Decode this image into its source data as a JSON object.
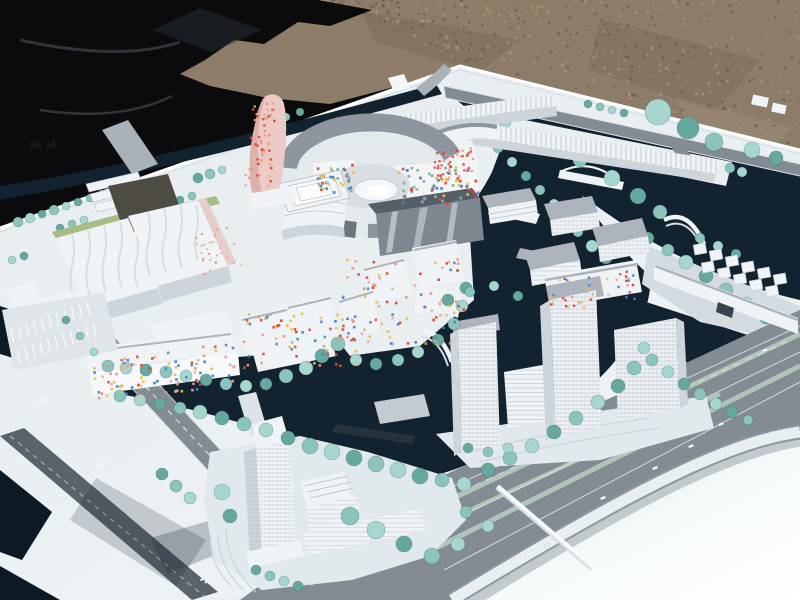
{
  "meta": {
    "subject": "photograph of a white architectural urban-planning scale model",
    "environment": "model lying outdoors on gravel ground, partly bordered by a black tarp",
    "features": [
      "white buildings",
      "dark navy canals",
      "seafoam model trees",
      "gray roads",
      "pink dotted tower",
      "circular courtyard complex with colorful mosaic facades",
      "arched white bridges",
      "curved highway ramp",
      "empty white plaza"
    ]
  },
  "palette": {
    "gravel": "#8d7c68",
    "gravel_dark": "#6b5d4c",
    "gravel_light": "#a6957e",
    "tarp": "#0b0b0d",
    "tarp_fold": "#32323a",
    "base": "#e9eef1",
    "base_bright": "#f6fafb",
    "base_shade": "#d4dce1",
    "water": "#12222f",
    "water_deep": "#0c1a26",
    "shallow": "#3e7a74",
    "tree_1": "#8ac4bb",
    "tree_2": "#a6d6cd",
    "tree_3": "#66a89e",
    "road": "#838b93",
    "road_dark": "#5a626c",
    "road_light": "#aab2b9",
    "median_green": "#b3c5b8",
    "curb": "#dde3e7",
    "bldg_white": "#f0f3f5",
    "bldg_face": "#cdd4da",
    "bldg_shade": "#b4bcc4",
    "roof_gray": "#8e959f",
    "roof_dark": "#6d747e",
    "roof_light": "#aeb4bc",
    "glass_dark": "#7e8690",
    "glass_ridge": "#565e68",
    "pink_tower": "#eccac5",
    "pink_shade": "#d9aba6",
    "green_strip": "#a9bc85",
    "dark_block": "#4e4a44",
    "red_face": "#b56c60",
    "dot_red": "#d94836",
    "dot_blue": "#4a82cc",
    "dot_yellow": "#e5c14e",
    "dot_salmon": "#e8937f",
    "dot_teal": "#7fb3a8",
    "dot_pink": "#e8a8a0",
    "shadow": "#1d2832"
  },
  "scene": {
    "speckle": {
      "count": 520,
      "seed": 7
    },
    "tree_colors": [
      "tree_1",
      "tree_2",
      "tree_3"
    ],
    "trees_back": [
      [
        18,
        222,
        5
      ],
      [
        30,
        218,
        5
      ],
      [
        42,
        214,
        4
      ],
      [
        54,
        210,
        5
      ],
      [
        66,
        206,
        4
      ],
      [
        78,
        202,
        4
      ],
      [
        90,
        198,
        4
      ],
      [
        102,
        194,
        4
      ],
      [
        198,
        178,
        5
      ],
      [
        210,
        174,
        5
      ],
      [
        222,
        170,
        4
      ],
      [
        310,
        142,
        4
      ],
      [
        322,
        138,
        4
      ],
      [
        334,
        134,
        4
      ],
      [
        300,
        112,
        4
      ],
      [
        286,
        117,
        4
      ],
      [
        658,
        112,
        13
      ],
      [
        688,
        128,
        11
      ],
      [
        714,
        142,
        9
      ],
      [
        752,
        150,
        8
      ],
      [
        776,
        158,
        7
      ],
      [
        480,
        112,
        7
      ],
      [
        505,
        122,
        6
      ],
      [
        548,
        143,
        7
      ],
      [
        580,
        160,
        7
      ],
      [
        612,
        178,
        8
      ],
      [
        638,
        196,
        8
      ],
      [
        660,
        212,
        7
      ],
      [
        475,
        128,
        4
      ],
      [
        488,
        131,
        4
      ],
      [
        501,
        134,
        4
      ],
      [
        514,
        137,
        4
      ],
      [
        588,
        104,
        4
      ],
      [
        600,
        107,
        4
      ],
      [
        612,
        110,
        4
      ],
      [
        624,
        113,
        4
      ],
      [
        730,
        168,
        5
      ],
      [
        742,
        172,
        5
      ],
      [
        648,
        238,
        6
      ],
      [
        668,
        250,
        6
      ],
      [
        686,
        262,
        7
      ],
      [
        706,
        276,
        7
      ],
      [
        726,
        290,
        7
      ],
      [
        746,
        304,
        7
      ],
      [
        766,
        318,
        6
      ],
      [
        700,
        238,
        5
      ],
      [
        718,
        246,
        5
      ],
      [
        736,
        254,
        5
      ],
      [
        498,
        148,
        5
      ],
      [
        512,
        162,
        5
      ],
      [
        526,
        176,
        5
      ],
      [
        540,
        190,
        5
      ],
      [
        554,
        204,
        5
      ],
      [
        566,
        218,
        5
      ],
      [
        578,
        232,
        5
      ],
      [
        592,
        246,
        6
      ],
      [
        606,
        258,
        6
      ],
      [
        350,
        128,
        4
      ],
      [
        362,
        124,
        4
      ],
      [
        374,
        121,
        4
      ],
      [
        446,
        120,
        4
      ],
      [
        458,
        117,
        4
      ],
      [
        60,
        228,
        4
      ],
      [
        72,
        224,
        4
      ],
      [
        84,
        220,
        4
      ],
      [
        180,
        200,
        4
      ],
      [
        192,
        196,
        4
      ],
      [
        12,
        260,
        4
      ],
      [
        24,
        256,
        4
      ],
      [
        150,
        232,
        4
      ]
    ],
    "trees_front": [
      [
        108,
        366,
        6
      ],
      [
        126,
        368,
        6
      ],
      [
        146,
        370,
        6
      ],
      [
        166,
        372,
        6
      ],
      [
        186,
        376,
        6
      ],
      [
        206,
        380,
        6
      ],
      [
        226,
        384,
        6
      ],
      [
        246,
        386,
        6
      ],
      [
        266,
        384,
        6
      ],
      [
        286,
        376,
        7
      ],
      [
        306,
        368,
        7
      ],
      [
        322,
        356,
        7
      ],
      [
        338,
        344,
        7
      ],
      [
        356,
        360,
        6
      ],
      [
        376,
        364,
        6
      ],
      [
        398,
        360,
        6
      ],
      [
        418,
        352,
        6
      ],
      [
        438,
        340,
        6
      ],
      [
        454,
        324,
        6
      ],
      [
        462,
        306,
        6
      ],
      [
        466,
        288,
        6
      ],
      [
        120,
        396,
        6
      ],
      [
        140,
        400,
        6
      ],
      [
        160,
        404,
        6
      ],
      [
        180,
        408,
        6
      ],
      [
        200,
        412,
        7
      ],
      [
        222,
        418,
        7
      ],
      [
        244,
        424,
        7
      ],
      [
        266,
        430,
        7
      ],
      [
        288,
        438,
        7
      ],
      [
        310,
        446,
        8
      ],
      [
        332,
        452,
        8
      ],
      [
        354,
        458,
        8
      ],
      [
        376,
        464,
        8
      ],
      [
        398,
        470,
        8
      ],
      [
        420,
        476,
        8
      ],
      [
        442,
        480,
        7
      ],
      [
        464,
        484,
        7
      ],
      [
        488,
        470,
        7
      ],
      [
        510,
        458,
        7
      ],
      [
        532,
        446,
        7
      ],
      [
        554,
        432,
        7
      ],
      [
        576,
        418,
        7
      ],
      [
        598,
        402,
        7
      ],
      [
        618,
        386,
        7
      ],
      [
        634,
        368,
        7
      ],
      [
        644,
        348,
        6
      ],
      [
        448,
        300,
        6
      ],
      [
        470,
        292,
        5
      ],
      [
        494,
        286,
        5
      ],
      [
        518,
        296,
        5
      ],
      [
        652,
        360,
        6
      ],
      [
        668,
        372,
        6
      ],
      [
        684,
        384,
        6
      ],
      [
        700,
        394,
        6
      ],
      [
        716,
        404,
        6
      ],
      [
        732,
        412,
        6
      ],
      [
        748,
        420,
        5
      ],
      [
        222,
        492,
        8
      ],
      [
        230,
        516,
        7
      ],
      [
        350,
        516,
        9
      ],
      [
        376,
        530,
        9
      ],
      [
        404,
        544,
        8
      ],
      [
        432,
        556,
        8
      ],
      [
        458,
        544,
        7
      ],
      [
        256,
        570,
        5
      ],
      [
        270,
        576,
        5
      ],
      [
        284,
        581,
        5
      ],
      [
        298,
        586,
        5
      ],
      [
        466,
        512,
        6
      ],
      [
        488,
        526,
        6
      ],
      [
        66,
        320,
        4
      ],
      [
        80,
        336,
        4
      ],
      [
        94,
        352,
        4
      ],
      [
        162,
        474,
        6
      ],
      [
        176,
        486,
        6
      ],
      [
        190,
        498,
        6
      ],
      [
        468,
        448,
        5
      ],
      [
        488,
        452,
        5
      ],
      [
        508,
        448,
        5
      ]
    ],
    "dot_zones": [
      {
        "name": "pink-tower-dots",
        "x": 246,
        "y": 100,
        "w": 26,
        "h": 88,
        "n": 55,
        "rot": 3,
        "size": 2.4,
        "colors": [
          "dot_salmon",
          "dot_red",
          "dot_pink"
        ]
      },
      {
        "name": "ring-left-mosaic",
        "x": 316,
        "y": 163,
        "w": 40,
        "h": 30,
        "n": 38,
        "rot": -6,
        "size": 2.7,
        "colors": [
          "dot_red",
          "dot_blue",
          "dot_teal",
          "dot_yellow"
        ]
      },
      {
        "name": "ring-right-mosaic",
        "x": 398,
        "y": 165,
        "w": 78,
        "h": 40,
        "n": 66,
        "rot": -4,
        "size": 2.8,
        "colors": [
          "dot_red",
          "dot_blue",
          "dot_teal",
          "dot_yellow"
        ]
      },
      {
        "name": "red-window-building",
        "x": 432,
        "y": 148,
        "w": 44,
        "h": 28,
        "n": 42,
        "rot": -8,
        "size": 2.2,
        "colors": [
          "dot_red",
          "dot_red",
          "dot_salmon"
        ]
      },
      {
        "name": "center-district-dots",
        "x": 340,
        "y": 258,
        "w": 124,
        "h": 86,
        "n": 85,
        "rot": 0,
        "size": 2.6,
        "colors": [
          "dot_red",
          "dot_blue",
          "dot_yellow",
          "dot_salmon",
          "dot_pink"
        ]
      },
      {
        "name": "u-cluster-dots",
        "x": 240,
        "y": 312,
        "w": 116,
        "h": 56,
        "n": 70,
        "rot": 0,
        "size": 2.6,
        "colors": [
          "dot_red",
          "dot_blue",
          "dot_yellow",
          "dot_salmon"
        ]
      },
      {
        "name": "long-building-mosaic",
        "x": 88,
        "y": 348,
        "w": 148,
        "h": 44,
        "n": 88,
        "rot": -6,
        "size": 2.6,
        "colors": [
          "dot_red",
          "dot_blue",
          "dot_yellow",
          "dot_salmon",
          "dot_pink"
        ]
      },
      {
        "name": "east-pale-row-dots",
        "x": 546,
        "y": 274,
        "w": 92,
        "h": 34,
        "n": 40,
        "rot": -8,
        "size": 2.4,
        "colors": [
          "dot_salmon",
          "dot_yellow",
          "dot_blue",
          "dot_red"
        ]
      },
      {
        "name": "west-slab-pink-face",
        "x": 196,
        "y": 228,
        "w": 40,
        "h": 46,
        "n": 28,
        "rot": -18,
        "size": 2.0,
        "colors": [
          "dot_salmon",
          "dot_pink"
        ]
      }
    ],
    "cars": [
      [
        718,
        424,
        -24
      ],
      [
        688,
        446,
        -24
      ],
      [
        652,
        468,
        -24
      ],
      [
        600,
        498,
        -26
      ],
      [
        762,
        350,
        -22
      ],
      [
        544,
        546,
        -28
      ]
    ],
    "road_marks": [
      [
        36,
        402,
        -33
      ],
      [
        96,
        466,
        -38
      ]
    ]
  }
}
